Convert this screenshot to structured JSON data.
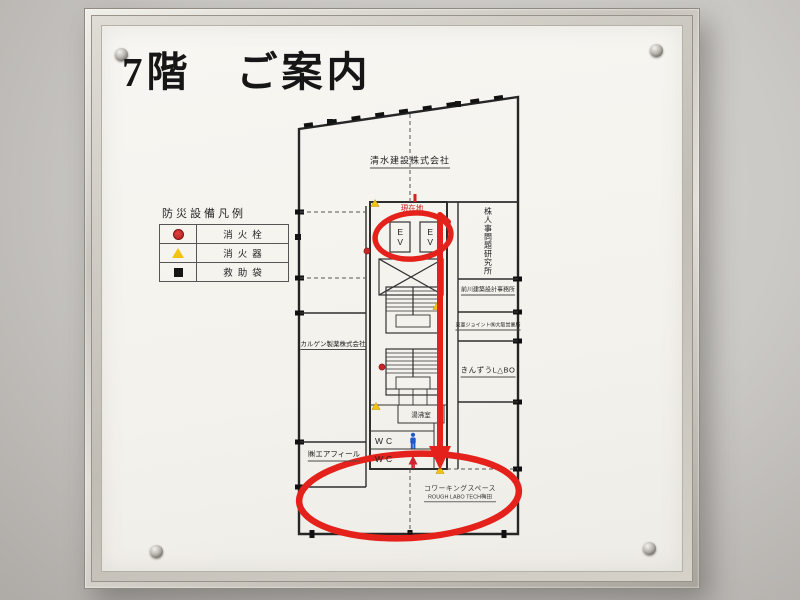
{
  "sign": {
    "title": "7階　ご案内"
  },
  "legend": {
    "heading": "防災設備凡例",
    "items": [
      {
        "icon": "fire-hydrant-dot",
        "label": "消火栓",
        "color": "#c42525"
      },
      {
        "icon": "fire-extinguisher-triangle",
        "label": "消火器",
        "color": "#f2c40e"
      },
      {
        "icon": "rescue-bag-square",
        "label": "救助袋",
        "color": "#151515"
      }
    ]
  },
  "floorplan": {
    "current_location": "現在地",
    "elevator": "EV",
    "tenants": {
      "top": "清水建設株式会社",
      "right_vertical": "株人事問題研究所",
      "maekawa": "前川建築設計事務所",
      "toa": "東亜ジョイント㈱大阪営業所",
      "kinzu": "きんずうL△BO",
      "karugen": "カルゲン製薬株式会社",
      "airfeel": "㈱エアフィール",
      "coworking_line1": "コワーキングスペース",
      "coworking_line2": "ROUGH LABO TECH梅田"
    },
    "rooms": {
      "kitchenette": "湯沸室",
      "wc": "WC"
    },
    "highlight_color": "#e5211b",
    "wc_icon_colors": {
      "men": "#1f58c8",
      "women": "#cf2430"
    }
  }
}
